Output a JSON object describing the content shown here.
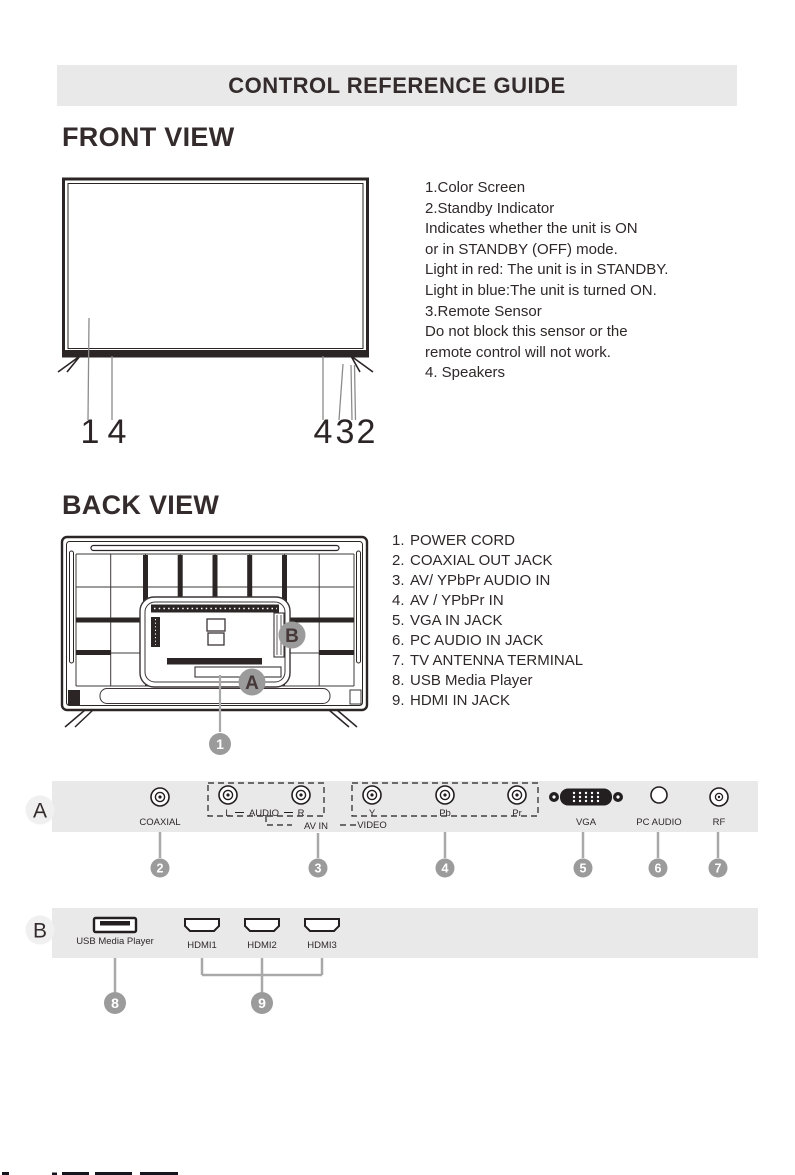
{
  "page": {
    "title": "CONTROL REFERENCE GUIDE"
  },
  "front_view": {
    "heading": "FRONT VIEW",
    "description_lines": [
      "1.Color Screen",
      "2.Standby Indicator",
      "Indicates whether the unit is ON",
      "or in STANDBY (OFF) mode.",
      "Light in red: The unit is in STANDBY.",
      "Light in blue:The unit is turned ON.",
      "3.Remote Sensor",
      "Do not block this sensor or the",
      "remote control will not work.",
      "4. Speakers"
    ],
    "callouts": {
      "one": "1",
      "four_left": "4",
      "four_right": "4",
      "three": "3",
      "two": "2"
    }
  },
  "back_view": {
    "heading": "BACK VIEW",
    "items": [
      {
        "num": "1.",
        "label": "POWER CORD"
      },
      {
        "num": "2.",
        "label": "COAXIAL OUT JACK"
      },
      {
        "num": "3.",
        "label": "AV/ YPbPr AUDIO IN"
      },
      {
        "num": "4.",
        "label": "AV / YPbPr IN"
      },
      {
        "num": "5.",
        "label": "VGA IN JACK"
      },
      {
        "num": "6.",
        "label": "PC AUDIO IN JACK"
      },
      {
        "num": "7.",
        "label": "TV ANTENNA TERMINAL"
      },
      {
        "num": "8.",
        "label": "USB Media Player"
      },
      {
        "num": "9.",
        "label": "HDMI IN JACK"
      }
    ],
    "callouts": {
      "a": "A",
      "b": "B",
      "one": "1"
    }
  },
  "panel_a": {
    "label": "A",
    "jack_labels": {
      "coaxial": "COAXIAL",
      "l": "L",
      "audio": "AUDIO",
      "r": "R",
      "av_in": "AV IN",
      "y": "Y",
      "video": "VIDEO",
      "pb": "Pb",
      "pr": "Pr",
      "vga": "VGA",
      "pc_audio": "PC AUDIO",
      "rf": "RF"
    },
    "callouts": [
      "2",
      "3",
      "4",
      "5",
      "6",
      "7"
    ]
  },
  "panel_b": {
    "label": "B",
    "usb_label": "USB Media Player",
    "hdmi_labels": [
      "HDMI1",
      "HDMI2",
      "HDMI3"
    ],
    "callouts": [
      "8",
      "9"
    ]
  },
  "colors": {
    "ink": "#2b2526",
    "strip_bg": "#e9e9e9",
    "badge_gray": "#9b9b9b",
    "leader_gray": "#a9a9a9"
  }
}
